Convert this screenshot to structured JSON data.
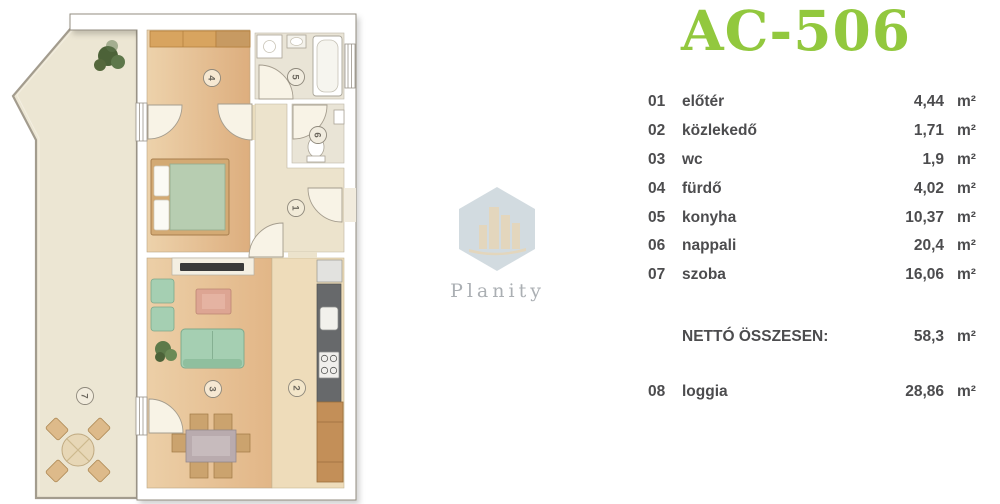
{
  "title": "AC-506",
  "colors": {
    "accent": "#92c83e",
    "legend_text": "#4c4c4e"
  },
  "watermark": {
    "brand": "Planity"
  },
  "legend": {
    "rows": [
      {
        "num": "01",
        "name": "előtér",
        "value": "4,44",
        "unit": "m²"
      },
      {
        "num": "02",
        "name": "közlekedő",
        "value": "1,71",
        "unit": "m²"
      },
      {
        "num": "03",
        "name": "wc",
        "value": "1,9",
        "unit": "m²"
      },
      {
        "num": "04",
        "name": "fürdő",
        "value": "4,02",
        "unit": "m²"
      },
      {
        "num": "05",
        "name": "konyha",
        "value": "10,37",
        "unit": "m²"
      },
      {
        "num": "06",
        "name": "nappali",
        "value": "20,4",
        "unit": "m²"
      },
      {
        "num": "07",
        "name": "szoba",
        "value": "16,06",
        "unit": "m²"
      }
    ],
    "total": {
      "label": "NETTÓ ÖSSZESEN:",
      "value": "58,3",
      "unit": "m²"
    },
    "loggia": {
      "num": "08",
      "name": "loggia",
      "value": "28,86",
      "unit": "m²"
    }
  },
  "floorplan": {
    "labels": [
      {
        "room": "loggia",
        "n": "7"
      },
      {
        "room": "bedroom",
        "n": "4"
      },
      {
        "room": "bathroom",
        "n": "5"
      },
      {
        "room": "wc",
        "n": "6"
      },
      {
        "room": "hall",
        "n": "1"
      },
      {
        "room": "living",
        "n": "3"
      },
      {
        "room": "kitchen",
        "n": "2"
      }
    ]
  }
}
